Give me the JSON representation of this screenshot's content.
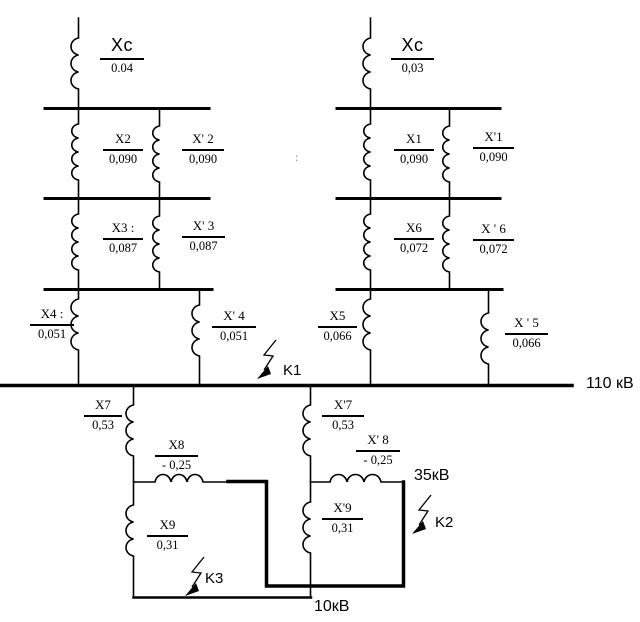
{
  "diagram": {
    "kind": "power-system equivalent impedance scheme",
    "voltages": {
      "v110": "110 кВ",
      "v35": "35кВ",
      "v10": "10кВ"
    },
    "faults": {
      "k1": "K1",
      "k2": "K2",
      "k3": "K3"
    },
    "artifact_colon": ":",
    "reactances": {
      "xc_l": {
        "name": "Xc",
        "value": "0.04"
      },
      "x2": {
        "name": "X2",
        "value": "0,090"
      },
      "x2p": {
        "name": "X' 2",
        "value": "0,090"
      },
      "x3": {
        "name": "X3 :",
        "value": "0,087"
      },
      "x3p": {
        "name": "X' 3",
        "value": "0,087"
      },
      "x4": {
        "name": "X4 :",
        "value": "0,051"
      },
      "x4p": {
        "name": "X' 4",
        "value": "0,051"
      },
      "xc_r": {
        "name": "Xc",
        "value": "0,03"
      },
      "x1": {
        "name": "X1",
        "value": "0,090"
      },
      "x1p": {
        "name": "X'1",
        "value": "0,090"
      },
      "x6": {
        "name": "X6",
        "value": "0,072"
      },
      "x6p": {
        "name": "X ' 6",
        "value": "0,072"
      },
      "x5": {
        "name": "X5",
        "value": "0,066"
      },
      "x5p": {
        "name": "X ' 5",
        "value": "0,066"
      },
      "x7": {
        "name": "X7",
        "value": "0,53"
      },
      "x8": {
        "name": "X8",
        "value": "- 0,25"
      },
      "x9": {
        "name": "X9",
        "value": "0,31"
      },
      "x7p": {
        "name": "X'7",
        "value": "0,53"
      },
      "x8p": {
        "name": "X' 8",
        "value": "- 0,25"
      },
      "x9p": {
        "name": "X'9",
        "value": "0,31"
      }
    }
  }
}
